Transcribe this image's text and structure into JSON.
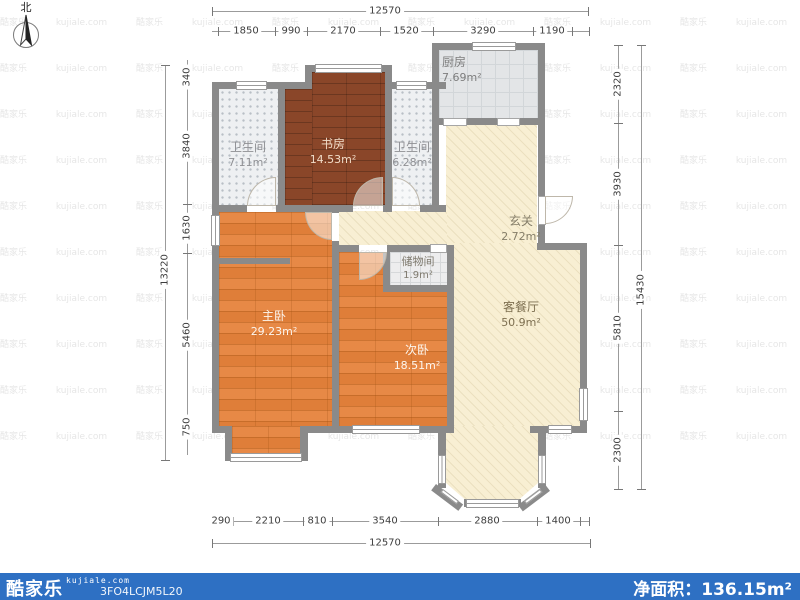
{
  "north_label": "北",
  "rooms": {
    "bath1": {
      "name": "卫生间",
      "area": "7.11m²"
    },
    "study": {
      "name": "书房",
      "area": "14.53m²"
    },
    "bath2": {
      "name": "卫生间",
      "area": "6.28m²"
    },
    "kitchen": {
      "name": "厨房",
      "area": "7.69m²"
    },
    "entry": {
      "name": "玄关",
      "area": "2.72m²"
    },
    "storage": {
      "name": "储物间",
      "area": "1.9m²"
    },
    "master": {
      "name": "主卧",
      "area": "29.23m²"
    },
    "bed2": {
      "name": "次卧",
      "area": "18.51m²"
    },
    "living": {
      "name": "客餐厅",
      "area": "50.9m²"
    }
  },
  "dimensions": {
    "top_total": "12570",
    "top_segments": [
      "1850",
      "990",
      "2170",
      "1520",
      "3290",
      "1190"
    ],
    "left_total": "13220",
    "left_segments": [
      "340",
      "3840",
      "1630",
      "5460",
      "750"
    ],
    "right_total": "15430",
    "right_segments": [
      "2320",
      "3930",
      "5810",
      "2300"
    ],
    "bottom_total": "12570",
    "bottom_segments": [
      "290",
      "2210",
      "810",
      "3540",
      "2880",
      "1400"
    ]
  },
  "footer": {
    "brand": "酷家乐",
    "brand_domain": "kujiale.com",
    "plan_code": "3FO4LCJM5L20",
    "net_area_label": "净面积：",
    "net_area_value": "136.15m²"
  },
  "colors": {
    "bar": "#2e70c3",
    "wall": "#8a8a8a",
    "wood_orange": "#e6823b",
    "wood_dark": "#8a4629",
    "cream": "#f8efd3",
    "tile": "#eef0f2",
    "dim_text": "#3d3d3d"
  }
}
